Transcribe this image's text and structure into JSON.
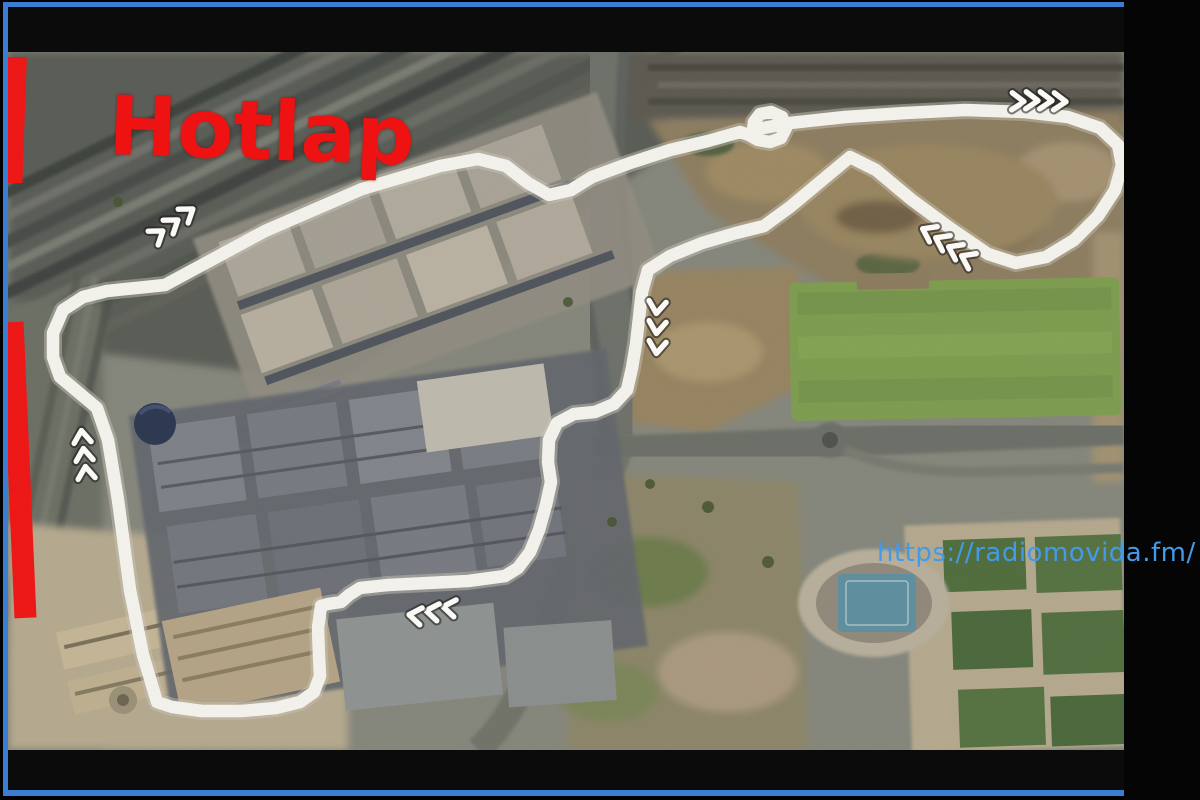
{
  "frame": {
    "border_color": "#3a7ed4",
    "letterbox_color": "#0b0b0b",
    "background_color": "#000000"
  },
  "title_overlay": {
    "text": "Hotlap",
    "color": "#ee1212"
  },
  "watermark": {
    "text": "https://radiomovida.fm/",
    "color": "#429ae8"
  },
  "track": {
    "label": "circuit-outline",
    "color": "#f4f2ec",
    "style": "hand-drawn closed loop over satellite photo"
  },
  "red_markers": {
    "color": "#ee1414",
    "count": 2,
    "positions": [
      "upper-left-edge",
      "mid-left-edge"
    ]
  },
  "chevron_sets": [
    {
      "id": "top-left",
      "count": 3,
      "direction": "northeast"
    },
    {
      "id": "top-right",
      "count": 4,
      "direction": "east"
    },
    {
      "id": "right-diagonal",
      "count": 4,
      "direction": "southwest"
    },
    {
      "id": "center-vertical",
      "count": 3,
      "direction": "south"
    },
    {
      "id": "west-side",
      "count": 3,
      "direction": "north"
    },
    {
      "id": "bottom",
      "count": 3,
      "direction": "west"
    }
  ],
  "map_features": [
    "rail-yard-top-left",
    "exhibition-halls-north",
    "exhibition-halls-south",
    "central-motorway",
    "east-motorway-roundabout",
    "large-green-field",
    "stadium-with-blue-pitch",
    "sports-fields-grid",
    "dirt-terrain-north-east"
  ]
}
